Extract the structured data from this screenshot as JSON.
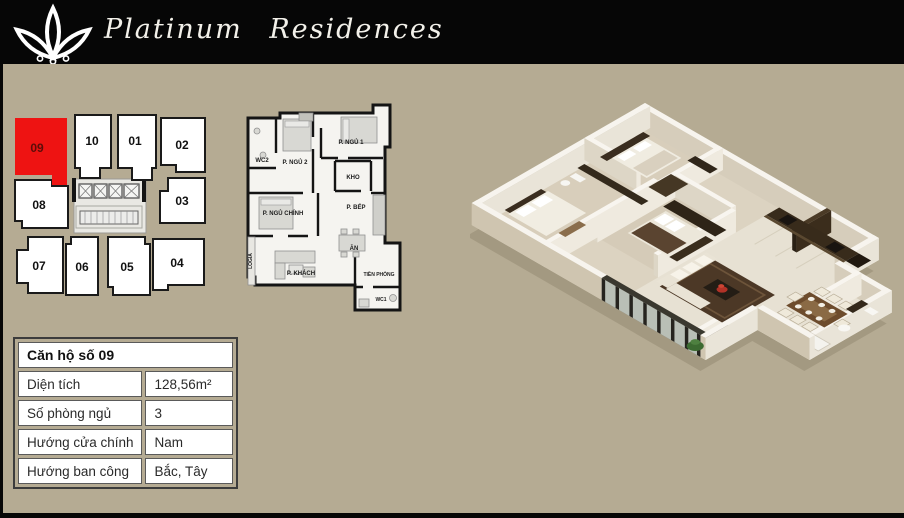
{
  "header": {
    "title": "Platinum Residences",
    "logo": "lotus-icon"
  },
  "key_plan": {
    "highlighted_unit": "09",
    "units": [
      {
        "label": "09",
        "highlighted": true
      },
      {
        "label": "10"
      },
      {
        "label": "01"
      },
      {
        "label": "02"
      },
      {
        "label": "08"
      },
      {
        "label": "03"
      },
      {
        "label": "07"
      },
      {
        "label": "06"
      },
      {
        "label": "05"
      },
      {
        "label": "04"
      }
    ]
  },
  "floor_plan_2d": {
    "rooms": [
      {
        "label": "WC2"
      },
      {
        "label": "P. NGỦ 2"
      },
      {
        "label": "P. NGỦ 1"
      },
      {
        "label": "KHO"
      },
      {
        "label": "P. NGỦ CHÍNH"
      },
      {
        "label": "P. BẾP"
      },
      {
        "label": "ĂN"
      },
      {
        "label": "LOGIA"
      },
      {
        "label": "P. KHÁCH"
      },
      {
        "label": "TIỀN PHÒNG"
      },
      {
        "label": "WC1"
      }
    ]
  },
  "info_table": {
    "title": "Căn hộ số 09",
    "rows": [
      {
        "label": "Diện tích",
        "value": "128,56m²"
      },
      {
        "label": "Số phòng ngủ",
        "value": "3"
      },
      {
        "label": "Hướng cửa chính",
        "value": "Nam"
      },
      {
        "label": "Hướng ban công",
        "value": "Bắc, Tây"
      }
    ]
  },
  "colors": {
    "background": "#b5ab93",
    "header_bg": "#060606",
    "highlight_red": "#ee1312",
    "unit_fill": "#ffffff",
    "wall_black": "#141414"
  }
}
